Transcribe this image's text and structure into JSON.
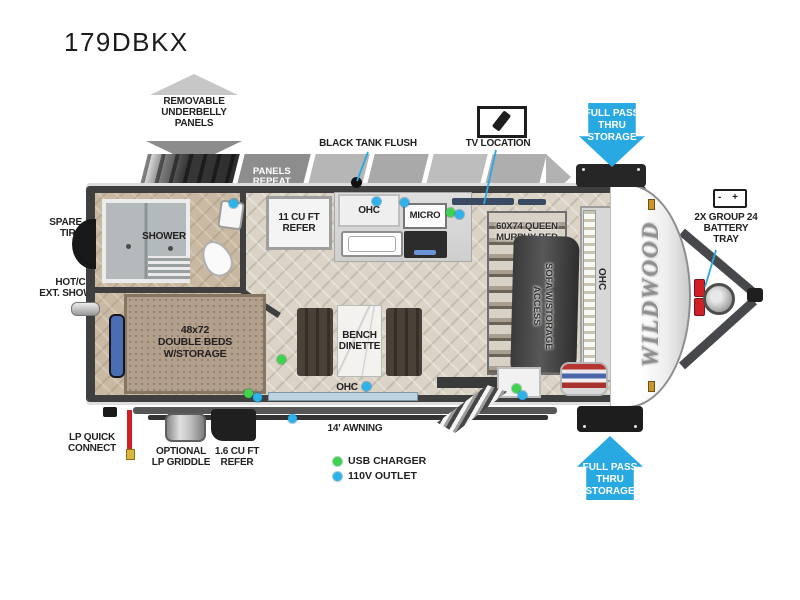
{
  "title": "179DBKX",
  "brand": "WILDWOOD",
  "colors": {
    "accent_blue": "#29a9e1",
    "dot_green": "#3ed24f",
    "dot_blue": "#2bb3ea",
    "lp_red": "#d01f26",
    "wall": "#3f3f3f"
  },
  "band": {
    "panels_repeat": "PANELS\nREPEAT"
  },
  "callouts": {
    "underbelly": "REMOVABLE\nUNDERBELLY\nPANELS",
    "black_tank_flush": "BLACK TANK FLUSH",
    "tv_location": "TV LOCATION",
    "pass_thru": "FULL PASS\nTHRU\nSTORAGE",
    "battery": "2X GROUP 24\nBATTERY\nTRAY",
    "spare_tire": "SPARE\nTIRE",
    "ext_shower": "HOT/COLD\nEXT. SHOWER",
    "lp_quick": "LP QUICK\nCONNECT",
    "griddle": "OPTIONAL\nLP GRIDDLE",
    "refer16": "1.6 CU FT\nREFER",
    "awning": "14' AWNING"
  },
  "rooms": {
    "shower": "SHOWER",
    "refer11": "11 CU FT\nREFER",
    "ohc": "OHC",
    "micro": "MICRO",
    "murphy": "60X74 QUEEN\nMURPHY BED",
    "sofa": "SOFA W/STORAGE\nACCESS",
    "double_beds": "48x72\nDOUBLE BEDS\nW/STORAGE",
    "dinette": "BENCH\nDINETTE"
  },
  "legend": [
    {
      "label": "USB CHARGER"
    },
    {
      "label": "110V OUTLET"
    }
  ],
  "icons": {
    "battery_text": "- +"
  }
}
